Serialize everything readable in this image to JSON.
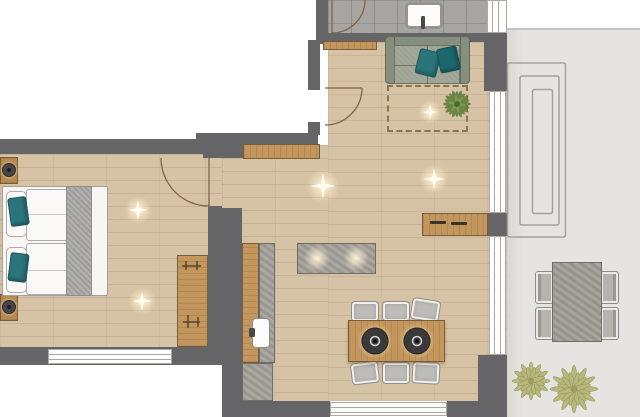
{
  "palette": {
    "wall": "#656568",
    "floor": "#d6c2a4",
    "tile": "#a8a4a1",
    "terrace": "#e6e4e1",
    "wood": "#c2965c",
    "woodDark": "#7a5c38",
    "stone": "#a7a39d",
    "stoneDark": "#6f6d69",
    "teal": "#2a747a",
    "tealDark": "#1d666d",
    "sofaSeat": "#9ca392",
    "sofaFrame": "#868f7d",
    "linen": "#faf9f7",
    "runner": "#b2b0ad",
    "chair": "#bdbcb8",
    "chairEdge": "#f0efec",
    "plantIndoor": "#5f7f3c",
    "plantOutdoor": "#b7b87b",
    "lamp": "#3b3b3c",
    "windowFrame": "#fdfdfc",
    "windowLine": "#a8a8a6",
    "arc": "#7c6647",
    "rugDash": "#8a744e",
    "glow": "#fff6dd"
  },
  "floorplan": {
    "type": "apartment-top-view",
    "rooms": {
      "entry_bathroom": {
        "floor": "gray-tile",
        "fixtures": [
          "washbasin",
          "entry-door"
        ]
      },
      "adjacent_room": {
        "floor": "white-unrendered",
        "fixtures": [
          "door-to-hall"
        ]
      },
      "bedroom": {
        "floor": "wood",
        "fixtures": [
          "double-bed",
          "bed-runner",
          "accent-pillows",
          "nightstands",
          "table-lamps",
          "wardrobe",
          "window",
          "door"
        ],
        "accent_pillows": 2,
        "nightstands": 2
      },
      "living_kitchen": {
        "floor": "wood",
        "fixtures": [
          "sofa",
          "sofa-pillows",
          "rug",
          "indoor-plant",
          "lowboard-shelf",
          "hall-bench",
          "kitchen-counter",
          "kitchen-sink",
          "kitchen-island",
          "dining-table",
          "dining-chairs",
          "pendant-lamps",
          "sideboard",
          "windows"
        ],
        "sofa_pillows": 2,
        "dining_chairs": 6,
        "pendant_lamps": 2
      },
      "terrace": {
        "floor": "concrete",
        "fixtures": [
          "outdoor-table",
          "outdoor-chairs",
          "outdoor-plants",
          "step-marking"
        ],
        "outdoor_chairs": 4,
        "outdoor_plants": 2
      }
    },
    "light_flares": 5
  }
}
